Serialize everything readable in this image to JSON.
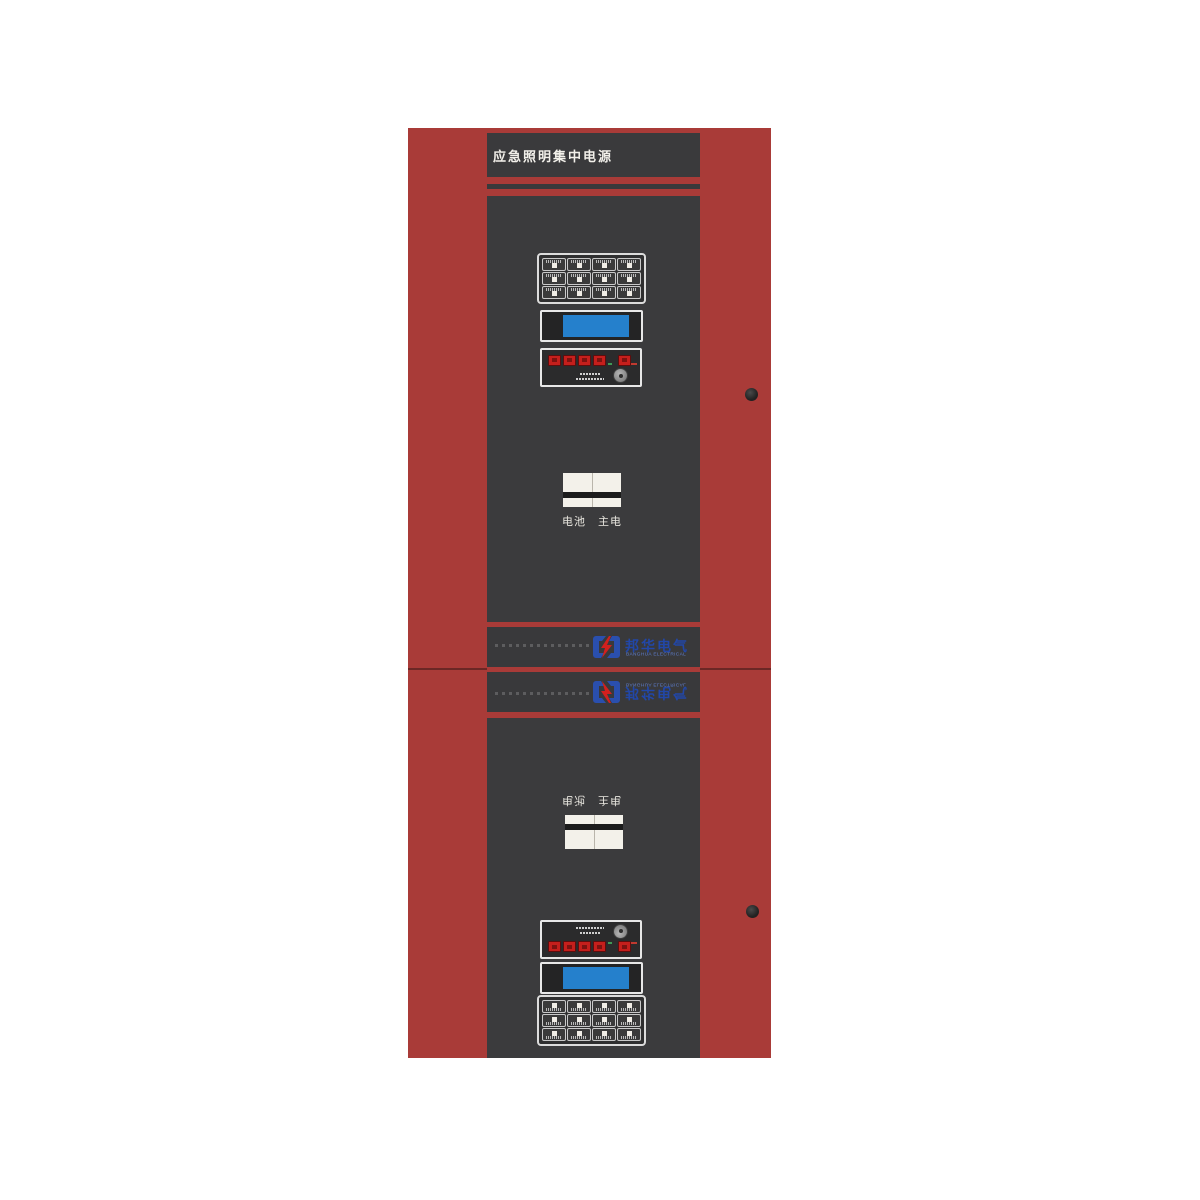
{
  "cabinet": {
    "title": "应急照明集中电源",
    "body_color": "#a93b38",
    "panel_color": "#3a3a3c",
    "unit_count": 2,
    "lower_unit_orientation": "flipped"
  },
  "lcd": {
    "screen_color": "#2580cc"
  },
  "switch": {
    "left_label": "电池",
    "right_label": "主电"
  },
  "logo": {
    "name_cn": "邦华电气",
    "name_en": "BANGHUA ELECTRICAL",
    "blue": "#2247a8",
    "red": "#d1201e"
  },
  "keypad": {
    "rows": 3,
    "cols": 4,
    "button_count": 12
  },
  "control_panel": {
    "red_buttons_left": 4,
    "red_buttons_right": 1,
    "has_key_knob": true
  }
}
